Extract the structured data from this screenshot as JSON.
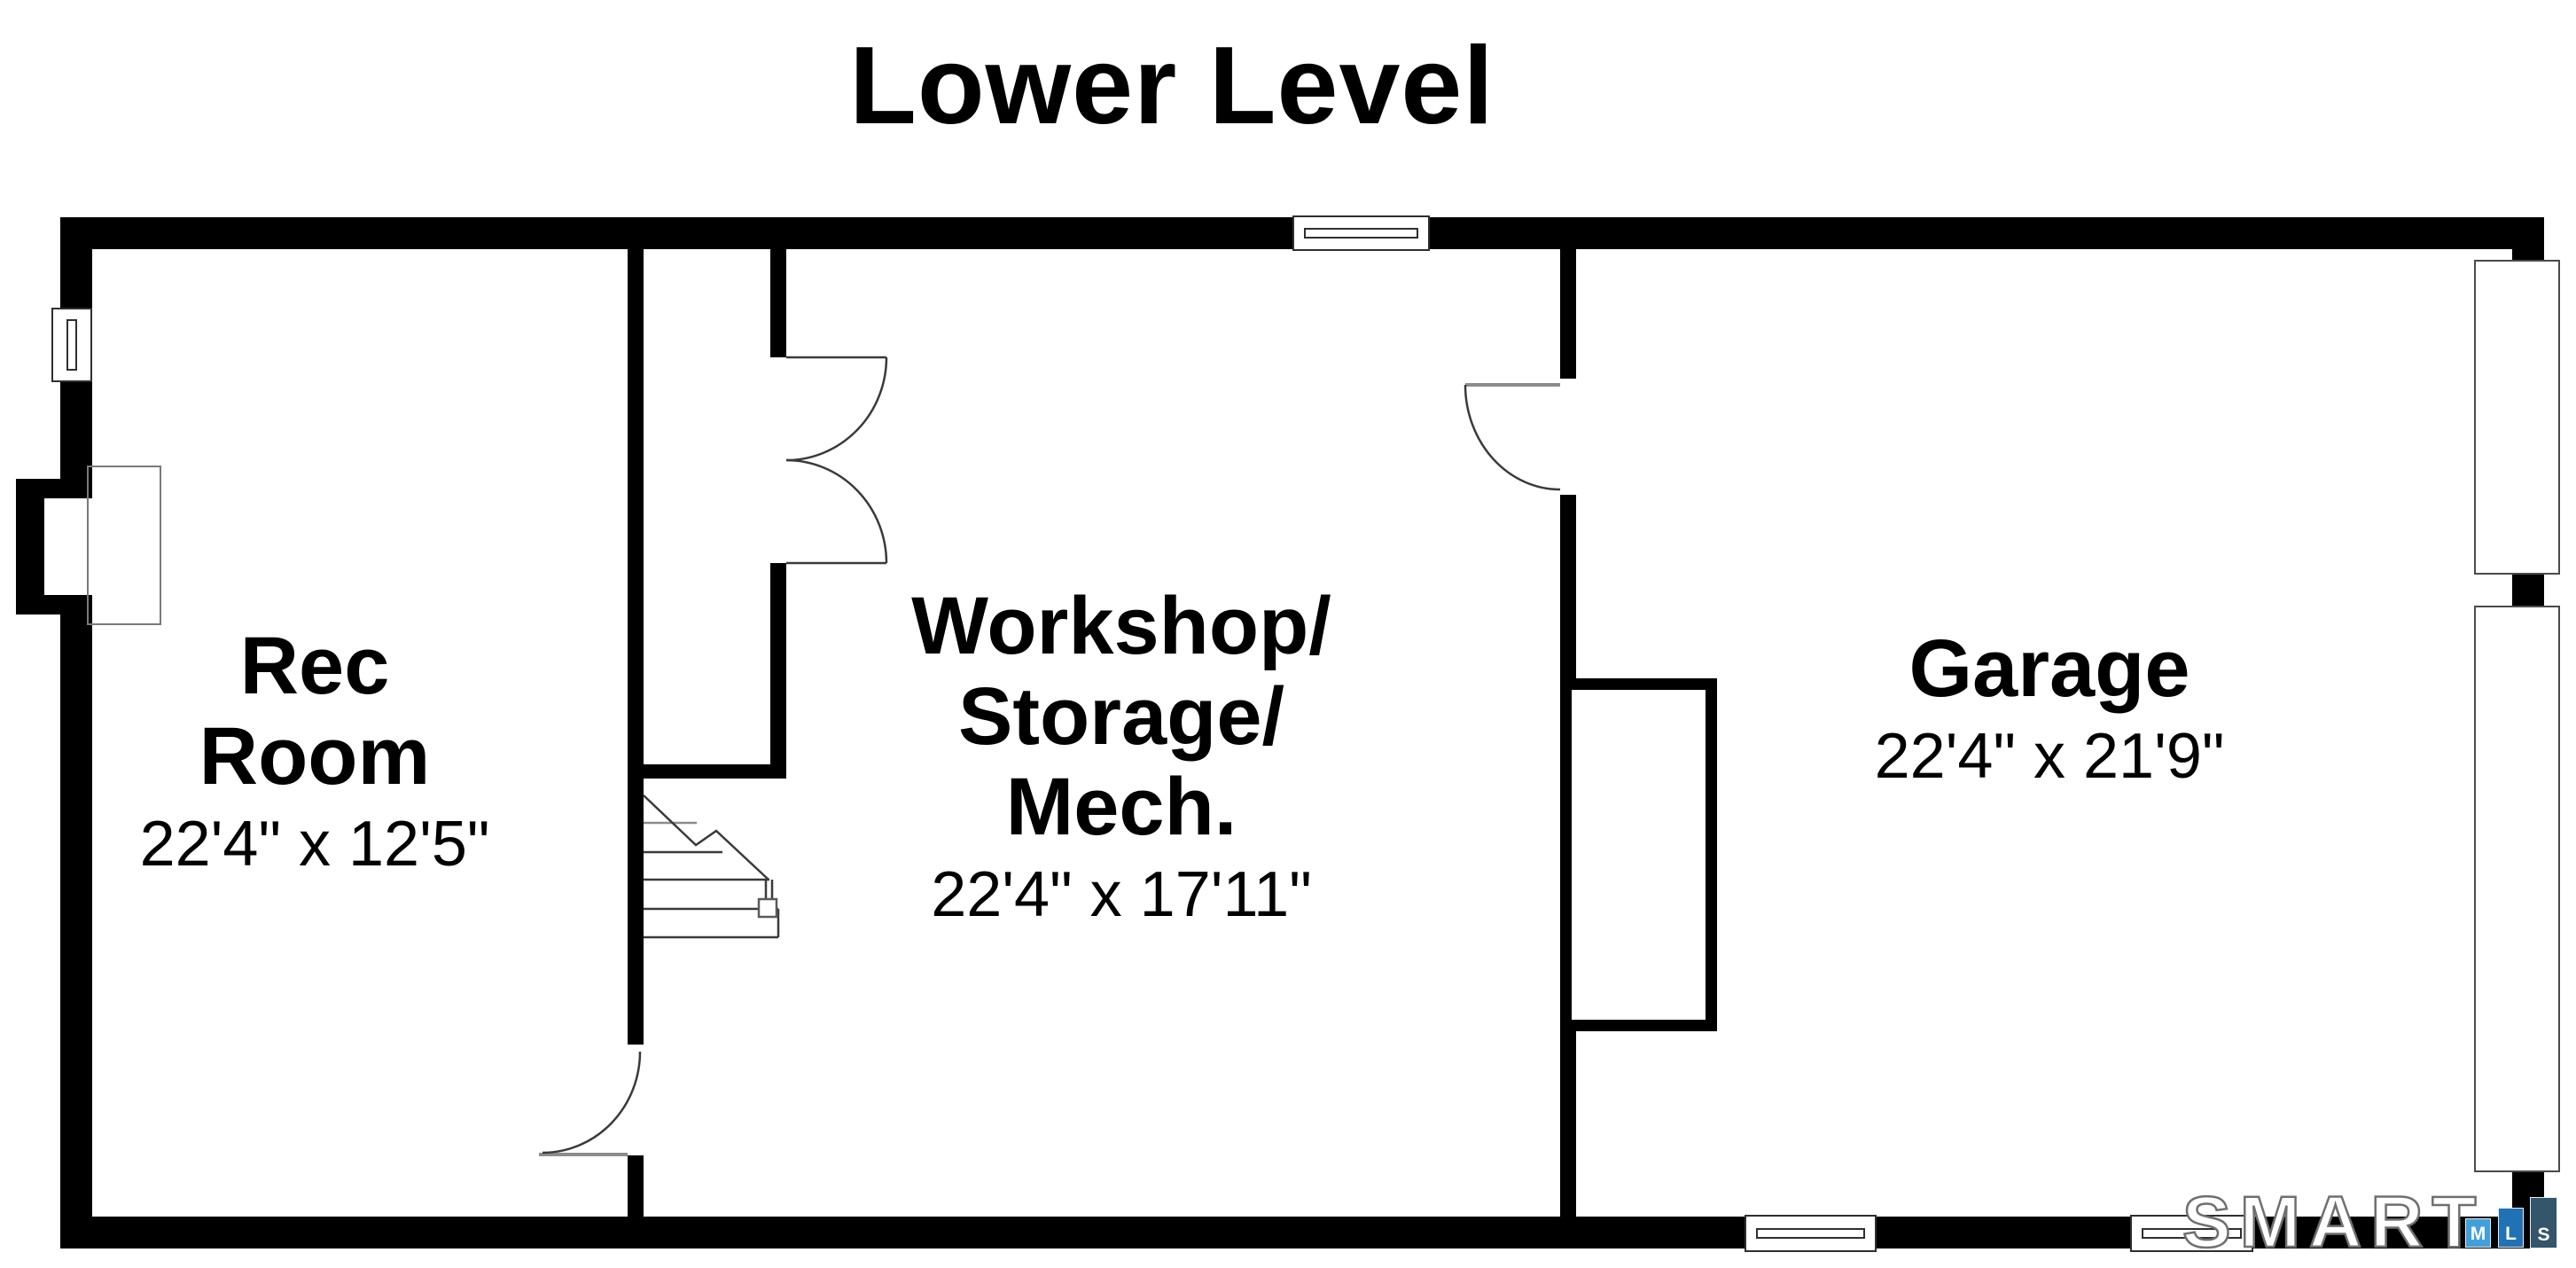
{
  "page": {
    "title": "Lower Level"
  },
  "rooms": {
    "rec": {
      "name_line1": "Rec",
      "name_line2": "Room",
      "dimensions": "22'4\" x 12'5\""
    },
    "workshop": {
      "name_line1": "Workshop/",
      "name_line2": "Storage/",
      "name_line3": "Mech.",
      "dimensions": "22'4\" x 17'11\""
    },
    "garage": {
      "name_line1": "Garage",
      "dimensions": "22'4\" x 21'9\""
    }
  },
  "watermark": {
    "brand": "SMART",
    "mls_letters": [
      "M",
      "L",
      "S"
    ],
    "colors": {
      "m_box": "#41a0d9",
      "l_box": "#2172b4",
      "s_box": "#33566b",
      "brand_outline": "#6f6f6f"
    }
  },
  "plan": {
    "wall_color": "#000000",
    "thin_line_color": "#3a3a3a",
    "door_leaf_color": "#8c8c8c"
  }
}
